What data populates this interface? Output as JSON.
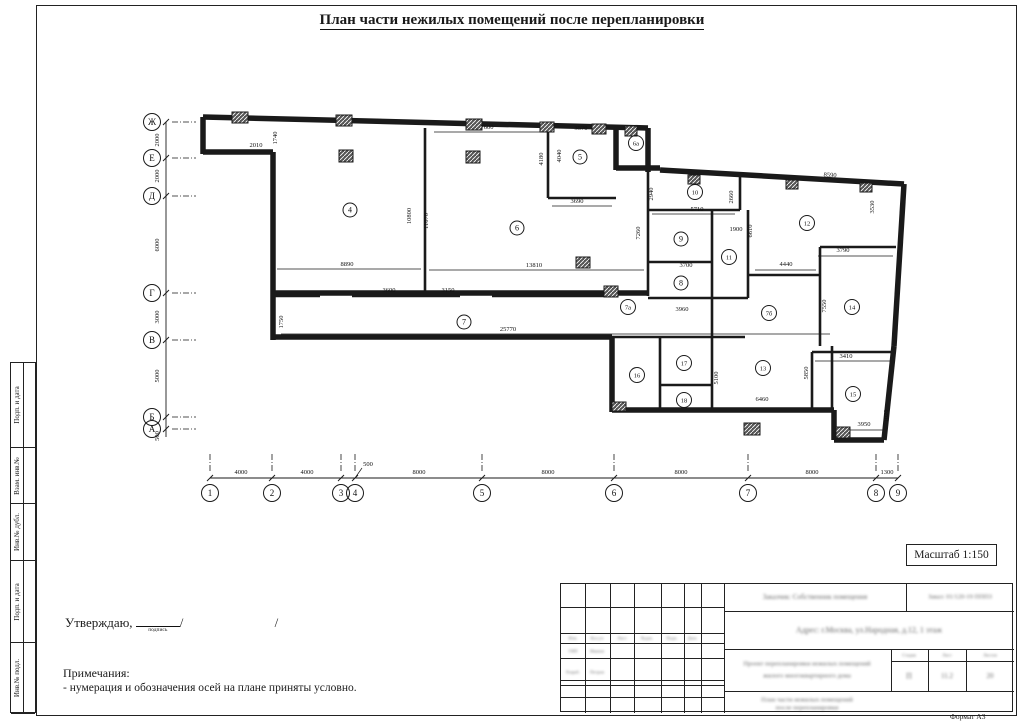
{
  "title": "План части нежилых помещений после перепланировки",
  "approve": {
    "label": "Утверждаю,",
    "signature_caption": "подпись",
    "slash1": "/",
    "slash2": "/"
  },
  "notes": {
    "heading": "Примечания:",
    "items": [
      "- нумерация и обозначения осей на плане приняты условно."
    ]
  },
  "scale_box": {
    "label": "Масштаб 1:150"
  },
  "format_label": "Формат А3",
  "side_strips": [
    {
      "label": "Подп. и дата",
      "h": 85
    },
    {
      "label": "Взам. инв.№",
      "h": 56
    },
    {
      "label": "Инв.№ дубл.",
      "h": 57
    },
    {
      "label": "Подп. и дата",
      "h": 82
    },
    {
      "label": "Инв.№ подл.",
      "h": 71
    }
  ],
  "title_block": {
    "customer": "Заказчик: Собственник помещения",
    "order": "Заказ: 01/120-19 ПППЗ",
    "address": "Адрес: г.Москва, ул.Народная, д.12, 1 этаж",
    "doc_title_line1": "Проект перепланировки нежилых помещений",
    "doc_title_line2": "жилого многоквартирного дома",
    "sheet_title_line1": "План части нежилых помещений",
    "sheet_title_line2": "после перепланировки",
    "stage_headers": [
      "Стадия",
      "Лист",
      "Листов"
    ],
    "stage_values": [
      "П",
      "11.2",
      "20"
    ],
    "left_cols_header": [
      "Изм.",
      "Кол.уч",
      "Лист",
      "№док.",
      "Подп.",
      "Дата"
    ],
    "left_rows": [
      [
        "ГИП",
        "Иванов"
      ],
      [
        "Разраб.",
        "Петров"
      ]
    ]
  },
  "plan": {
    "ink": "#1a1a1a",
    "axes_left": {
      "line_x": 166,
      "circle_x": 152,
      "y_top": 122,
      "y_bottom": 437,
      "marks": [
        {
          "label": "Ж",
          "y": 122
        },
        {
          "label": "Е",
          "y": 158
        },
        {
          "label": "Д",
          "y": 196
        },
        {
          "label": "Г",
          "y": 293
        },
        {
          "label": "В",
          "y": 340
        },
        {
          "label": "Б",
          "y": 417
        },
        {
          "label": "А",
          "y": 429
        }
      ],
      "dims": [
        {
          "t": "2000",
          "y": 140
        },
        {
          "t": "2000",
          "y": 176
        },
        {
          "t": "6000",
          "y": 245
        },
        {
          "t": "3000",
          "y": 317
        },
        {
          "t": "5000",
          "y": 376
        },
        {
          "t": "500",
          "y": 436
        }
      ]
    },
    "axes_bottom": {
      "line_y": 478,
      "circle_y": 493,
      "x_left": 210,
      "x_right": 898,
      "marks": [
        {
          "label": "1",
          "x": 210
        },
        {
          "label": "2",
          "x": 272
        },
        {
          "label": "3",
          "x": 341
        },
        {
          "label": "4",
          "x": 355
        },
        {
          "label": "5",
          "x": 482
        },
        {
          "label": "6",
          "x": 614
        },
        {
          "label": "7",
          "x": 748
        },
        {
          "label": "8",
          "x": 876
        },
        {
          "label": "9",
          "x": 898
        }
      ],
      "dims": [
        {
          "t": "4000",
          "x": 241
        },
        {
          "t": "4000",
          "x": 307
        },
        {
          "t": "8000",
          "x": 419
        },
        {
          "t": "8000",
          "x": 548
        },
        {
          "t": "8000",
          "x": 681
        },
        {
          "t": "8000",
          "x": 812
        },
        {
          "t": "1300",
          "x": 887
        }
      ],
      "leader_dim": {
        "t": "500",
        "x": 362,
        "y": 466
      }
    },
    "rooms": [
      {
        "label": "4",
        "x": 350,
        "y": 210
      },
      {
        "label": "5",
        "x": 580,
        "y": 157
      },
      {
        "label": "6",
        "x": 517,
        "y": 228
      },
      {
        "label": "6а",
        "x": 636,
        "y": 143
      },
      {
        "label": "7",
        "x": 464,
        "y": 322
      },
      {
        "label": "7а",
        "x": 628,
        "y": 307
      },
      {
        "label": "7б",
        "x": 769,
        "y": 313
      },
      {
        "label": "8",
        "x": 681,
        "y": 283
      },
      {
        "label": "9",
        "x": 681,
        "y": 239
      },
      {
        "label": "10",
        "x": 695,
        "y": 192
      },
      {
        "label": "11",
        "x": 729,
        "y": 257
      },
      {
        "label": "12",
        "x": 807,
        "y": 223
      },
      {
        "label": "13",
        "x": 763,
        "y": 368
      },
      {
        "label": "14",
        "x": 852,
        "y": 307
      },
      {
        "label": "15",
        "x": 853,
        "y": 394
      },
      {
        "label": "16",
        "x": 637,
        "y": 375
      },
      {
        "label": "17",
        "x": 684,
        "y": 363
      },
      {
        "label": "18",
        "x": 684,
        "y": 400
      }
    ],
    "dims": [
      {
        "t": "2010",
        "x": 256,
        "y": 147
      },
      {
        "t": "1740",
        "x": 277,
        "y": 138,
        "r": -90
      },
      {
        "t": "7600",
        "x": 487,
        "y": 129
      },
      {
        "t": "3570",
        "x": 581,
        "y": 130
      },
      {
        "t": "4180",
        "x": 543,
        "y": 159,
        "r": -90
      },
      {
        "t": "4040",
        "x": 561,
        "y": 156,
        "r": -90
      },
      {
        "t": "3690",
        "x": 577,
        "y": 203
      },
      {
        "t": "8890",
        "x": 347,
        "y": 266
      },
      {
        "t": "13810",
        "x": 534,
        "y": 267
      },
      {
        "t": "10800",
        "x": 411,
        "y": 216,
        "r": -90
      },
      {
        "t": "11070",
        "x": 428,
        "y": 221,
        "r": -90
      },
      {
        "t": "3600",
        "x": 389,
        "y": 292
      },
      {
        "t": "3150",
        "x": 448,
        "y": 292
      },
      {
        "t": "1750",
        "x": 283,
        "y": 322,
        "r": -90
      },
      {
        "t": "25770",
        "x": 508,
        "y": 331
      },
      {
        "t": "2940",
        "x": 653,
        "y": 194,
        "r": -90
      },
      {
        "t": "5710",
        "x": 697,
        "y": 211
      },
      {
        "t": "2660",
        "x": 733,
        "y": 197,
        "r": -90
      },
      {
        "t": "7260",
        "x": 640,
        "y": 233,
        "r": -90
      },
      {
        "t": "1900",
        "x": 736,
        "y": 231
      },
      {
        "t": "6610",
        "x": 752,
        "y": 231,
        "r": -90
      },
      {
        "t": "3700",
        "x": 686,
        "y": 267
      },
      {
        "t": "4440",
        "x": 786,
        "y": 266
      },
      {
        "t": "8590",
        "x": 830,
        "y": 177,
        "r": 3
      },
      {
        "t": "3530",
        "x": 874,
        "y": 207,
        "r": -90
      },
      {
        "t": "3790",
        "x": 843,
        "y": 252
      },
      {
        "t": "7550",
        "x": 826,
        "y": 306,
        "r": -90
      },
      {
        "t": "3960",
        "x": 682,
        "y": 311
      },
      {
        "t": "5100",
        "x": 718,
        "y": 378,
        "r": -90
      },
      {
        "t": "6460",
        "x": 762,
        "y": 401
      },
      {
        "t": "3410",
        "x": 846,
        "y": 358
      },
      {
        "t": "5850",
        "x": 808,
        "y": 373,
        "r": -90
      },
      {
        "t": "3950",
        "x": 864,
        "y": 426
      },
      {
        "t": "1020",
        "x": 888,
        "y": 416,
        "r": -90
      }
    ],
    "walls_ext": [
      [
        203,
        117,
        648,
        128
      ],
      [
        203,
        117,
        203,
        154
      ],
      [
        203,
        152,
        273,
        152
      ],
      [
        273,
        152,
        273,
        340
      ],
      [
        273,
        337,
        612,
        337
      ],
      [
        612,
        337,
        612,
        412
      ],
      [
        612,
        410,
        834,
        410
      ],
      [
        834,
        410,
        834,
        440
      ],
      [
        834,
        440,
        884,
        440
      ],
      [
        884,
        440,
        894,
        346
      ],
      [
        894,
        346,
        904,
        184
      ],
      [
        660,
        170,
        904,
        184
      ],
      [
        648,
        128,
        648,
        172
      ],
      [
        616,
        128,
        616,
        170
      ],
      [
        616,
        168,
        660,
        168
      ],
      [
        273,
        293,
        648,
        293
      ]
    ],
    "walls_int": [
      [
        425,
        128,
        425,
        293
      ],
      [
        548,
        128,
        548,
        198
      ],
      [
        548,
        198,
        616,
        198
      ],
      [
        273,
        296,
        320,
        296
      ],
      [
        352,
        296,
        460,
        296
      ],
      [
        492,
        296,
        612,
        296
      ],
      [
        648,
        172,
        648,
        296
      ],
      [
        648,
        298,
        748,
        298
      ],
      [
        648,
        210,
        740,
        210
      ],
      [
        740,
        172,
        740,
        210
      ],
      [
        712,
        210,
        712,
        298
      ],
      [
        648,
        262,
        712,
        262
      ],
      [
        748,
        210,
        748,
        298
      ],
      [
        748,
        275,
        820,
        275
      ],
      [
        820,
        247,
        896,
        247
      ],
      [
        820,
        247,
        820,
        346
      ],
      [
        812,
        352,
        893,
        352
      ],
      [
        812,
        352,
        812,
        412
      ],
      [
        712,
        298,
        712,
        412
      ],
      [
        660,
        337,
        660,
        412
      ],
      [
        660,
        385,
        712,
        385
      ],
      [
        612,
        337,
        712,
        337
      ],
      [
        712,
        337,
        745,
        337
      ],
      [
        832,
        346,
        832,
        410
      ]
    ],
    "thin_lines": [
      [
        277,
        269,
        421,
        269
      ],
      [
        429,
        270,
        644,
        270
      ],
      [
        281,
        334,
        830,
        334
      ],
      [
        434,
        132,
        541,
        132
      ],
      [
        552,
        206,
        612,
        206
      ],
      [
        652,
        214,
        735,
        214
      ],
      [
        755,
        270,
        816,
        270
      ],
      [
        818,
        256,
        893,
        256
      ],
      [
        815,
        361,
        890,
        361
      ],
      [
        838,
        430,
        886,
        430
      ],
      [
        355,
        478,
        362,
        468
      ]
    ],
    "columns": [
      [
        232,
        112,
        16,
        11
      ],
      [
        336,
        115,
        16,
        11
      ],
      [
        466,
        119,
        16,
        11
      ],
      [
        540,
        122,
        14,
        10
      ],
      [
        592,
        124,
        14,
        10
      ],
      [
        625,
        126,
        12,
        10
      ],
      [
        339,
        150,
        14,
        12
      ],
      [
        466,
        151,
        14,
        12
      ],
      [
        604,
        286,
        14,
        11
      ],
      [
        744,
        423,
        16,
        12
      ],
      [
        836,
        427,
        14,
        11
      ],
      [
        612,
        402,
        14,
        9
      ],
      [
        688,
        175,
        12,
        9
      ],
      [
        786,
        180,
        12,
        9
      ],
      [
        860,
        183,
        12,
        9
      ],
      [
        576,
        257,
        14,
        11
      ]
    ]
  }
}
